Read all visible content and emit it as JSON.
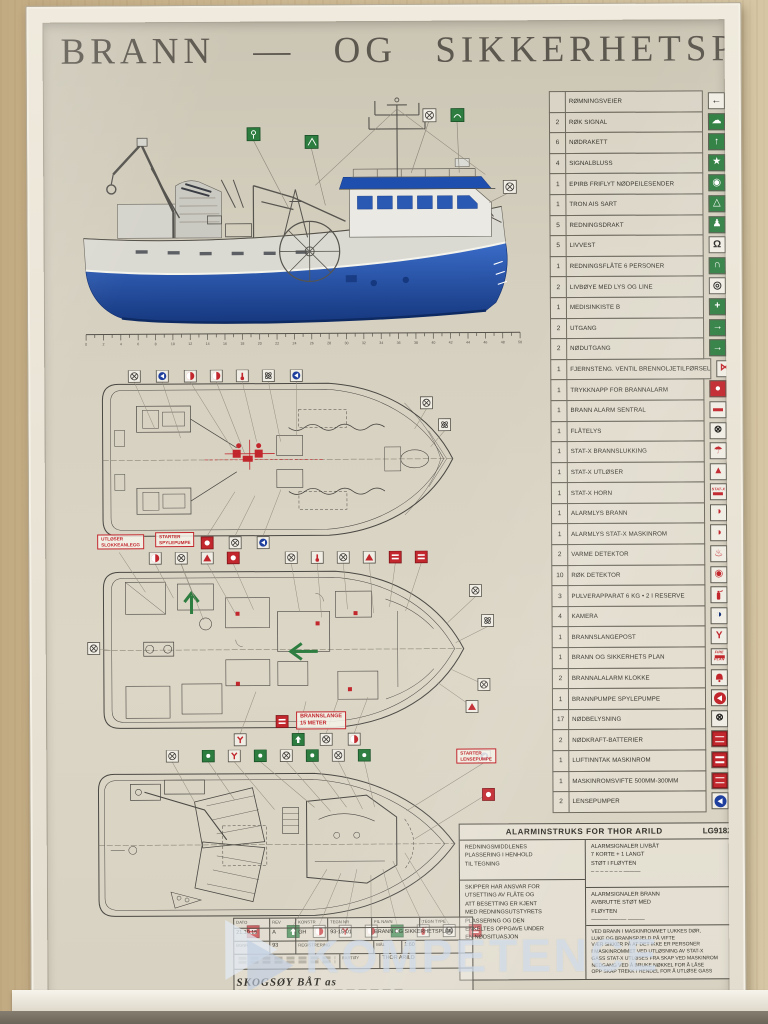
{
  "colors": {
    "green": "#2c7d3f",
    "red": "#c1272d",
    "blue": "#1f3f9e",
    "hull_blue": "#2a59b4",
    "navy": "#14337a"
  },
  "title": "BRANN — OG SIKKERHETSPLAN",
  "profile": {
    "ruler": {
      "start": 0,
      "end": 50,
      "step": 2
    }
  },
  "plan_labels": {
    "utloser_slokkeanlegg": "UTLØSER\nSLOKKEANLEGG",
    "starter_spylepumpe": "STARTER\nSPYLEPUMPE",
    "brannslange": "BRANNSLANGE\n15 METER",
    "starter_lensepumpe": "STARTER\nLENSEPUMPE"
  },
  "legend": {
    "rows": [
      {
        "n": "",
        "label": "RØMNINGSVEIER",
        "name": "escape-route-arrow-icon",
        "icon": {
          "bg": "white",
          "glyph": "←",
          "color": "#1d1d1b",
          "bold": true
        }
      },
      {
        "n": "2",
        "label": "RØK SIGNAL",
        "name": "smoke-signal-icon",
        "icon": {
          "bg": "green",
          "glyph": "☁",
          "color": "#ffffff"
        }
      },
      {
        "n": "6",
        "label": "NØDRAKETT",
        "name": "rocket-flare-icon",
        "icon": {
          "bg": "green",
          "glyph": "↑",
          "color": "#ffffff",
          "bold": true
        }
      },
      {
        "n": "4",
        "label": "SIGNALBLUSS",
        "name": "signal-flare-icon",
        "icon": {
          "bg": "green",
          "glyph": "★",
          "color": "#ffffff"
        }
      },
      {
        "n": "1",
        "label": "EPIRB FRIFLYT NØDPEILESENDER",
        "name": "epirb-icon",
        "icon": {
          "bg": "green",
          "glyph": "◉",
          "color": "#ffffff"
        }
      },
      {
        "n": "1",
        "label": "TRON AIS SART",
        "name": "ais-sart-icon",
        "icon": {
          "bg": "green",
          "glyph": "△",
          "color": "#ffffff"
        }
      },
      {
        "n": "5",
        "label": "REDNINGSDRAKT",
        "name": "immersion-suit-icon",
        "icon": {
          "bg": "green",
          "glyph": "♟",
          "color": "#ffffff"
        }
      },
      {
        "n": "5",
        "label": "LIVVEST",
        "name": "lifejacket-icon",
        "icon": {
          "bg": "white",
          "glyph": "Ω",
          "color": "#23221f",
          "bold": true
        }
      },
      {
        "n": "1",
        "label": "REDNINGSFLÅTE 6 PERSONER",
        "name": "liferaft-icon",
        "icon": {
          "bg": "green",
          "glyph": "∩",
          "color": "#ffffff",
          "bold": true
        }
      },
      {
        "n": "2",
        "label": "LIVBØYE MED LYS OG LINE",
        "name": "lifebuoy-icon",
        "icon": {
          "bg": "white",
          "glyph": "◎",
          "color": "#23221f",
          "bold": true
        }
      },
      {
        "n": "1",
        "label": "MEDISINKISTE B",
        "name": "first-aid-kit-icon",
        "icon": {
          "bg": "green",
          "glyph": "+",
          "color": "#ffffff",
          "bold": true
        }
      },
      {
        "n": "2",
        "label": "UTGANG",
        "name": "exit-sign-icon",
        "icon": {
          "bg": "green",
          "glyph": "→",
          "color": "#ffffff",
          "bold": true
        }
      },
      {
        "n": "2",
        "label": "NØDUTGANG",
        "name": "emergency-exit-icon",
        "icon": {
          "bg": "green",
          "glyph": "→",
          "color": "#ffffff",
          "bold": true
        }
      },
      {
        "n": "1",
        "label": "FJERNSTENG. VENTIL BRENNOLJETILFØRSEL",
        "name": "fuel-shutoff-valve-icon",
        "icon": {
          "bg": "white",
          "glyph": "⋈",
          "color": "#c1272d",
          "bold": true
        }
      },
      {
        "n": "1",
        "label": "TRYKKNAPP FOR BRANNALARM",
        "name": "fire-alarm-button-icon",
        "icon": {
          "bg": "red",
          "glyph": "●",
          "color": "#ffffff"
        }
      },
      {
        "n": "1",
        "label": "BRANN ALARM SENTRAL",
        "name": "fire-alarm-panel-icon",
        "icon": {
          "bg": "white",
          "glyph": "▬",
          "color": "#c1272d"
        }
      },
      {
        "n": "1",
        "label": "FLÅTELYS",
        "name": "raft-light-icon",
        "icon": {
          "bg": "white",
          "glyph": "⊗",
          "color": "#23221f",
          "bold": true
        }
      },
      {
        "n": "1",
        "label": "STAT-X BRANNSLUKKING",
        "name": "statx-extinguishing-icon",
        "icon": {
          "bg": "white",
          "glyph": "☂",
          "color": "#c1272d"
        }
      },
      {
        "n": "1",
        "label": "STAT-X UTLØSER",
        "name": "statx-release-icon",
        "icon": {
          "bg": "white",
          "glyph": "▲",
          "color": "#c1272d"
        }
      },
      {
        "n": "1",
        "label": "STAT-X HORN",
        "name": "statx-horn-icon",
        "icon": {
          "special": "statx",
          "text": "STAT-X"
        }
      },
      {
        "n": "1",
        "label": "ALARMLYS  BRANN",
        "name": "fire-alarm-light-icon",
        "icon": {
          "bg": "white",
          "glyph": "◑",
          "color": "#c1272d"
        }
      },
      {
        "n": "1",
        "label": "ALARMLYS  STAT-X  MASKINROM",
        "name": "statx-alarm-light-icon",
        "icon": {
          "bg": "white",
          "glyph": "◑",
          "color": "#c1272d"
        }
      },
      {
        "n": "2",
        "label": "VARME DETEKTOR",
        "name": "heat-detector-icon",
        "icon": {
          "bg": "white",
          "glyph": "♨",
          "color": "#c1272d"
        }
      },
      {
        "n": "10",
        "label": "RØK DETEKTOR",
        "name": "smoke-detector-icon",
        "icon": {
          "bg": "white",
          "glyph": "◉",
          "color": "#c1272d"
        }
      },
      {
        "n": "3",
        "label": "PULVERAPPARAT 6 KG  • 2 I RESERVE",
        "name": "powder-extinguisher-icon",
        "icon": {
          "special": "ext"
        }
      },
      {
        "n": "4",
        "label": "KAMERA",
        "name": "camera-icon",
        "icon": {
          "bg": "white",
          "glyph": "◑",
          "color": "#14337a"
        }
      },
      {
        "n": "1",
        "label": "BRANNSLANGEPOST",
        "name": "fire-hose-station-icon",
        "icon": {
          "bg": "white",
          "glyph": "Y",
          "color": "#c1272d",
          "bold": true
        }
      },
      {
        "n": "1",
        "label": "BRANN OG SIKKERHETS PLAN",
        "name": "fire-plan-icon",
        "icon": {
          "special": "fireplan",
          "lines": [
            "FIRE",
            "PLAN"
          ]
        }
      },
      {
        "n": "2",
        "label": "BRANNALALARM KLOKKE",
        "name": "fire-alarm-bell-icon",
        "icon": {
          "special": "bell"
        }
      },
      {
        "n": "1",
        "label": "BRANNPUMPE    SPYLEPUMPE",
        "name": "fire-pump-icon",
        "icon": {
          "special": "pump",
          "color": "#c1272d"
        }
      },
      {
        "n": "17",
        "label": "NØDBELYSNING",
        "name": "emergency-light-icon",
        "icon": {
          "bg": "white",
          "glyph": "⊗",
          "color": "#23221f",
          "bold": true
        }
      },
      {
        "n": "2",
        "label": "NØDKRAFT-BATTERIER",
        "name": "emergency-battery-icon",
        "icon": {
          "special": "redlines"
        }
      },
      {
        "n": "1",
        "label": "LUFTINNTAK MASKINROM",
        "name": "air-intake-icon",
        "icon": {
          "special": "redlines"
        }
      },
      {
        "n": "1",
        "label": "MASKINROMSVIFTE 500MM-300MM",
        "name": "engine-room-fan-icon",
        "icon": {
          "special": "redlines"
        }
      },
      {
        "n": "2",
        "label": "LENSEPUMPER",
        "name": "bilge-pump-icon",
        "icon": {
          "special": "pump",
          "color": "#1f3f9e"
        }
      }
    ]
  },
  "alarm_box": {
    "title": "ALARMINSTRUKS FOR THOR ARILD",
    "reg": "LG9182",
    "left1": "REDNINGSMIDDLENES\nPLASSERING I HENHOLD\nTIL TEGNING",
    "right1": "ALARMSIGNALER LIVBÅT\n7 KORTE + 1 LANGT\nSTØT I FLØYTEN\n– – – – – – –   ———",
    "left2": "SKIPPER HAR ANSVAR FOR\nUTSETTING AV FLÅTE OG\nATT BESETTING ER KJENT\nMED REDNINGSUTSTYRETS\nPLASSERING OG DEN\nENKELTES OPPGAVE UNDER\nEN NØDSITUASJON",
    "right2": "ALARMSIGNALER BRANN\nAVBRUTTE STØT MED\nFLØYTEN\n——— ——— ———",
    "right3": "VED BRANN I MASKINROMMET LUKKES DØR,\nLUKE OG BRANNSPJELD PÅ VIFTE\nVÆR SIKKER PÅ AT DET IKKE ER PERSONER\nI MASKINROMMET VED UTLØSNING AV STAT-X\nGASS STAT-X UTLØSES FRA SKAP VED MASKINROM\nNEDGANG VED Å BRUKE NØKKEL FOR Å LÅSE\nOPP SKAP TREKK I HENDEL FOR Å UTLØSE GASS"
  },
  "title_block": {
    "h_dato": "DATO",
    "h_rev": "REV",
    "h_konstr": "KONSTR",
    "h_tegnnr": "TEGN NR",
    "h_filnavn": "FIL NAVN",
    "h_tegntype": "TEGN TYPE",
    "h_bgnr": "BGNR.",
    "h_registrering": "REGISTRERING",
    "h_mal": "MÅL",
    "h_fartoy": "FARTØY",
    "v_dato": "21.10.15",
    "v_rev": "A",
    "v_konstr": "GH",
    "v_tegnnr": "93-15-01",
    "v_filnavn": "BRANN OG SIKKERHETSPLAN",
    "v_bgnr": "93",
    "v_mal": "1:60",
    "v_fartoy": "THOR ARILD",
    "company": "SKOGSØY BÅT as"
  },
  "watermark": {
    "text": "KOMPETENCE"
  }
}
